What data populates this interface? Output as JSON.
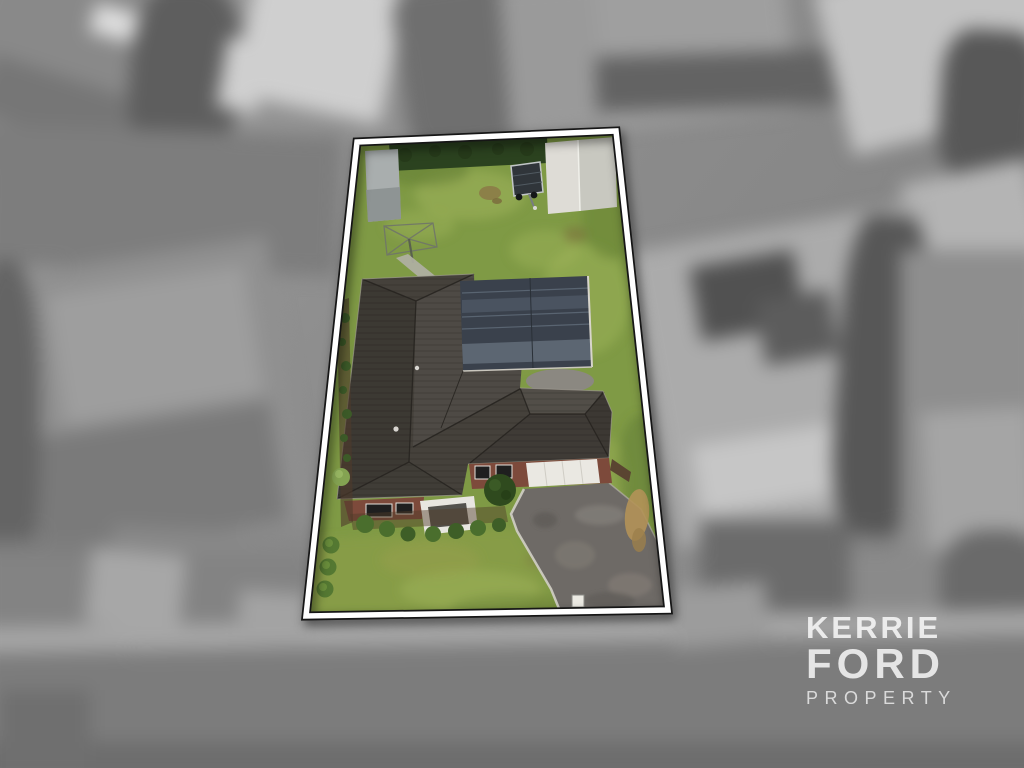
{
  "watermark": {
    "line1": "KERRIE",
    "line2": "FORD",
    "line3": "PROPERTY"
  },
  "scene": {
    "description": "Aerial drone photo of a residential lot highlighted in colour with a white outlined boundary; surrounding neighbourhood is desaturated grayscale and blurred; agency watermark bottom right",
    "colors": {
      "grass": "#7f9a45",
      "front_lawn": "#93a14c",
      "hedge": "#2b421f",
      "roof": "#45413b",
      "solar_glass": "#3a414c",
      "porch": "#e8e6e0",
      "garage_door": "#eae8e2",
      "brick": "#7d4a3b",
      "driveway": "#6e6a66",
      "shed_left": "#a9aeae",
      "shed_right": "#dedcd6",
      "shed_right_shade": "#c8c8c0",
      "path": "#b0b0a4",
      "courtyard": "#8b8881",
      "trailer": "#30353a",
      "entry_bush": "#2f4a1e",
      "bush": "#4a6e2d",
      "mulch": "#4e3a2b",
      "sand": "#b29258",
      "mailbox": "#eceae3",
      "boundary_band": "#ffffff",
      "boundary_edge": "#161616",
      "watermark_text": "#ffffff"
    }
  }
}
